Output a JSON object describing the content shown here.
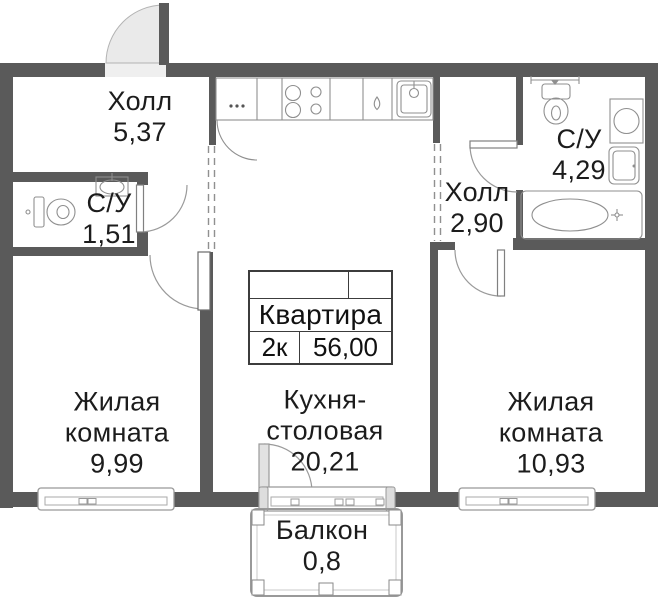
{
  "plan_type": "apartment-floor-plan",
  "apartment_table": {
    "name": "Квартира",
    "rooms_count": "2к",
    "total_area": "56,00"
  },
  "rooms": {
    "hall1": {
      "name": "Холл",
      "area": "5,37"
    },
    "bath1": {
      "name": "С/У",
      "area": "1,51"
    },
    "hall2": {
      "name": "Холл",
      "area": "2,90"
    },
    "bath2": {
      "name": "С/У",
      "area": "4,29"
    },
    "living1": {
      "name": "Жилая комната",
      "area": "9,99"
    },
    "kitchen": {
      "name": "Кухня-столовая",
      "area": "20,21"
    },
    "living2": {
      "name": "Жилая комната",
      "area": "10,93"
    },
    "balcony": {
      "name": "Балкон",
      "area": "0,8"
    }
  },
  "fixtures": [
    "entrance-door-icon",
    "door-arc",
    "toilet-icon",
    "sink-icon",
    "bathroom-sink-icon",
    "bathtub-icon",
    "washing-machine-icon",
    "stove-icon",
    "fridge-icon",
    "dishwasher-icon",
    "kitchen-sink-icon",
    "kitchen-counter-icon",
    "window-icon",
    "balcony-window-icon",
    "balcony-railing-icon",
    "open-boundary-dashes"
  ],
  "colors": {
    "wall": "#5a5a5a",
    "fixture_line": "#8f8f8f",
    "door_fill": "#eaeaea",
    "text": "#1c1c1c"
  }
}
